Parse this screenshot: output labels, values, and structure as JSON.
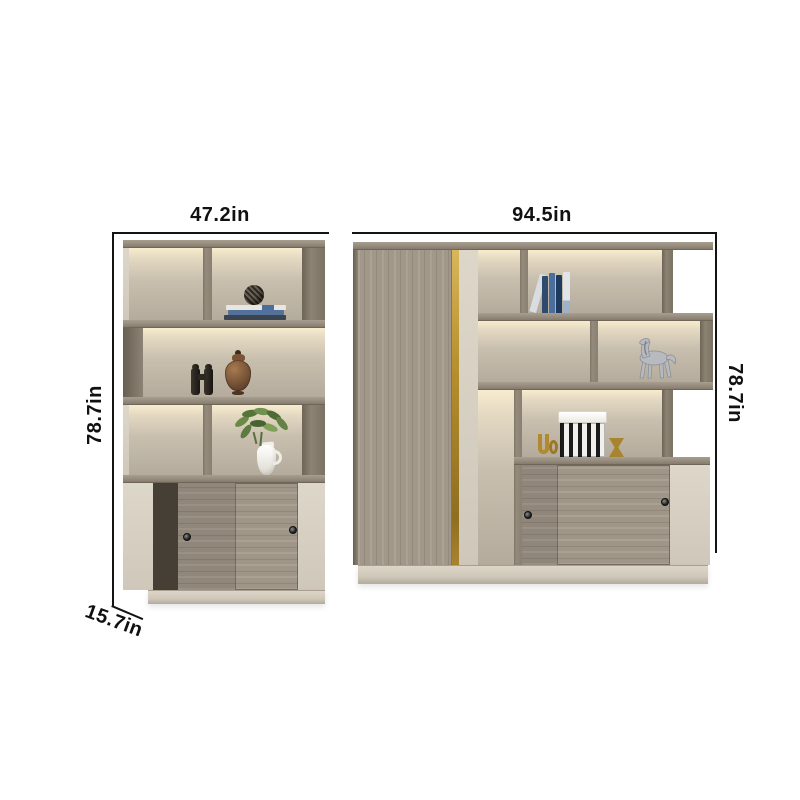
{
  "annotations": {
    "left_unit": {
      "width_label": "47.2in",
      "height_label": "78.7in",
      "depth_label": "15.7in"
    },
    "right_unit": {
      "width_label": "94.5in",
      "height_label": "78.7in"
    }
  },
  "colors": {
    "background": "#ffffff",
    "dimension_line": "#141414",
    "label_text": "#111111",
    "wood_frame": "#9a9184",
    "wood_dark_edge": "#6f6659",
    "door_grain": "#a2988a",
    "panel_cream": "#d9d3c6",
    "bay_back": "#bdb4a5",
    "led_glow": "#f8ecce",
    "gold_accent": "#b8912f",
    "base_plinth": "#d9d2c4",
    "interior_dark": "#453f35"
  },
  "decor": {
    "left_unit": [
      "wire-sphere",
      "book-stack",
      "binoculars",
      "bronze-vase",
      "green-plant",
      "white-pitcher"
    ],
    "right_unit": [
      "blue-books",
      "horse-figurine",
      "striped-hatbox",
      "gold-ornaments"
    ]
  }
}
